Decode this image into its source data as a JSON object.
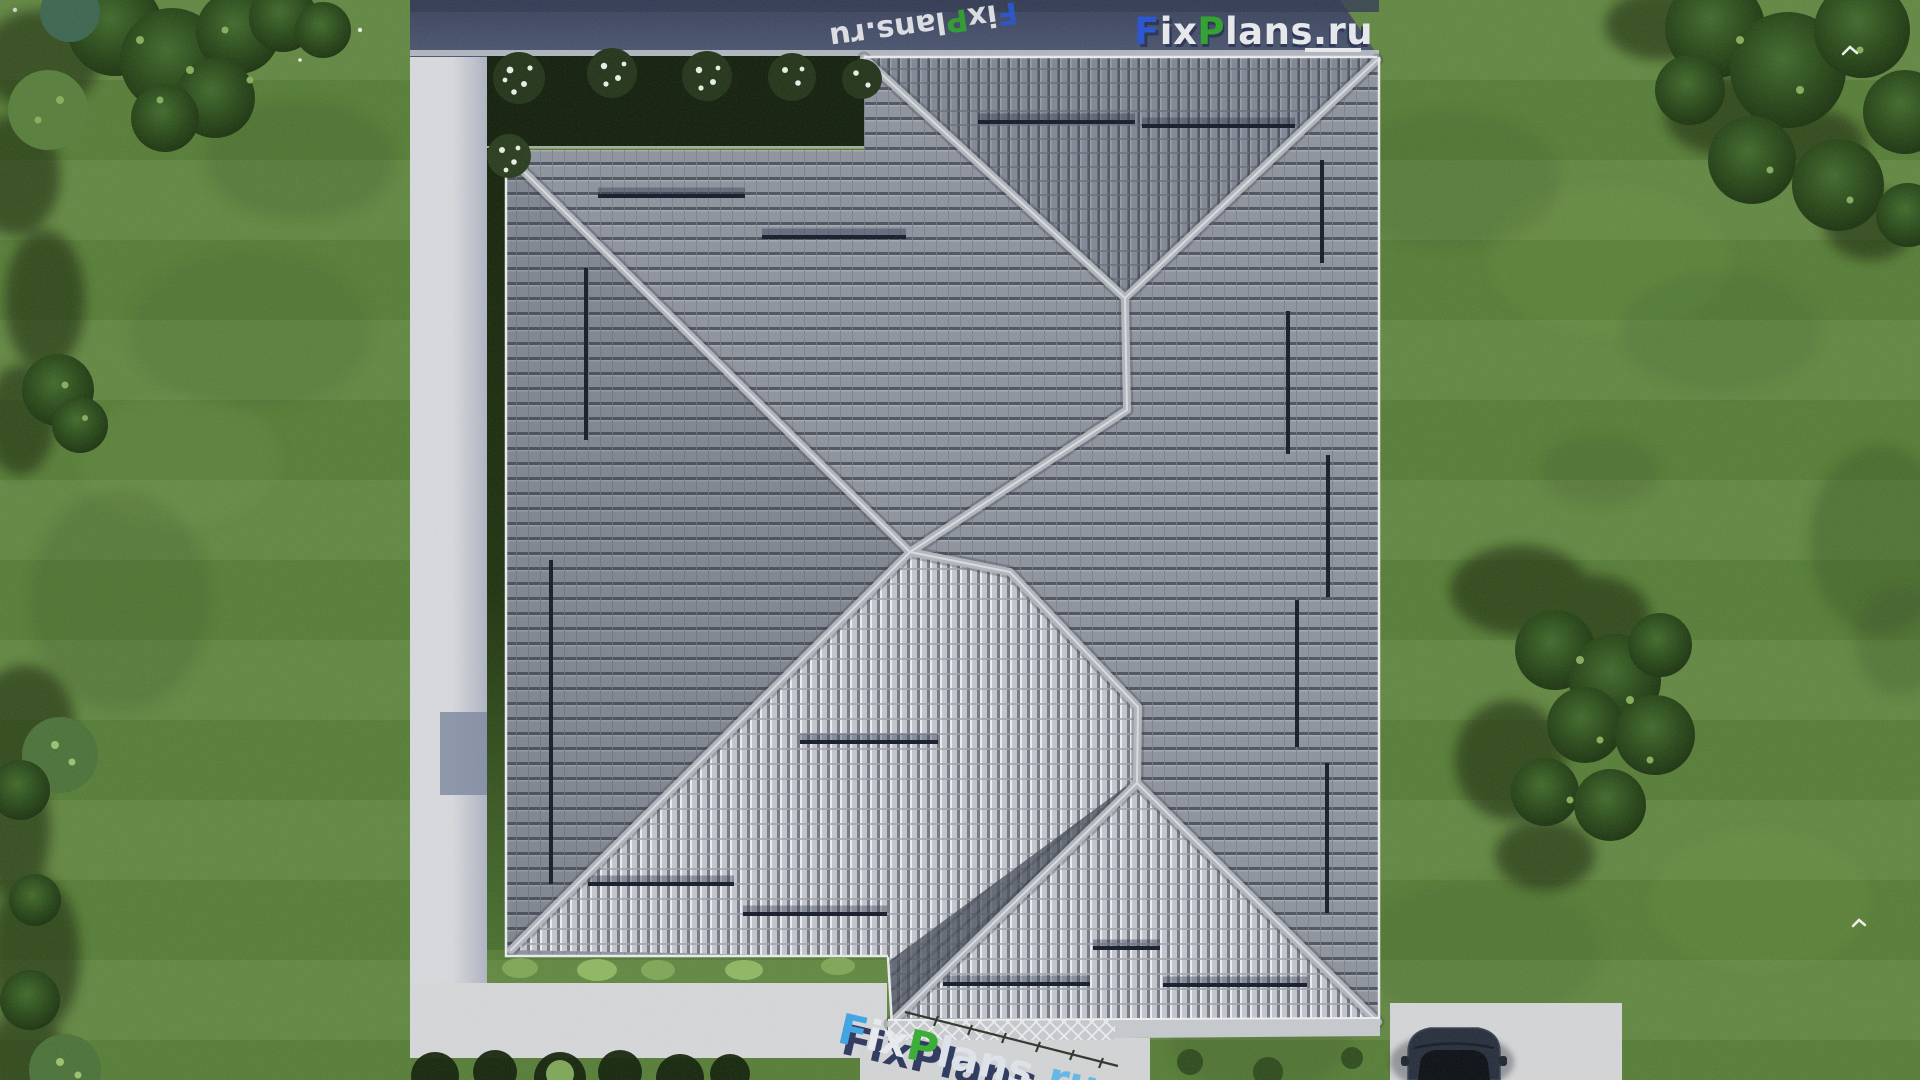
{
  "brand": {
    "full": "FixPlans.ru",
    "seg_f": "F",
    "seg_ix": "ix",
    "seg_p": "P",
    "seg_lans": "lans",
    "seg_dotru": ".ru"
  },
  "watermarks": {
    "top_right_logo_text": "FixPlans.ru",
    "top_edge_diagonal_text": "FixPlans.ru",
    "bottom_ground_text": "FixPlans.ru"
  },
  "colors": {
    "logo_blue": "#2753cf",
    "logo_green": "#2ca32c",
    "logo_light": "#e9eaee",
    "bottom_f_blue": "#3ea4e4",
    "bottom_p_green": "#36ad33",
    "shadow_navy": "#1c2750",
    "roof_gray": "#8d929d",
    "roof_bright": "#c3c6cc",
    "ridge_cap": "#b2b6bd",
    "grass": "#5c833b",
    "path_concrete": "#d7d8da",
    "north_shadow_band": "#454f66",
    "garden_bed": "#14200d",
    "car_navy": "#272f3d"
  },
  "icons": {
    "bird_1": "bird-icon",
    "bird_2": "bird-icon"
  }
}
